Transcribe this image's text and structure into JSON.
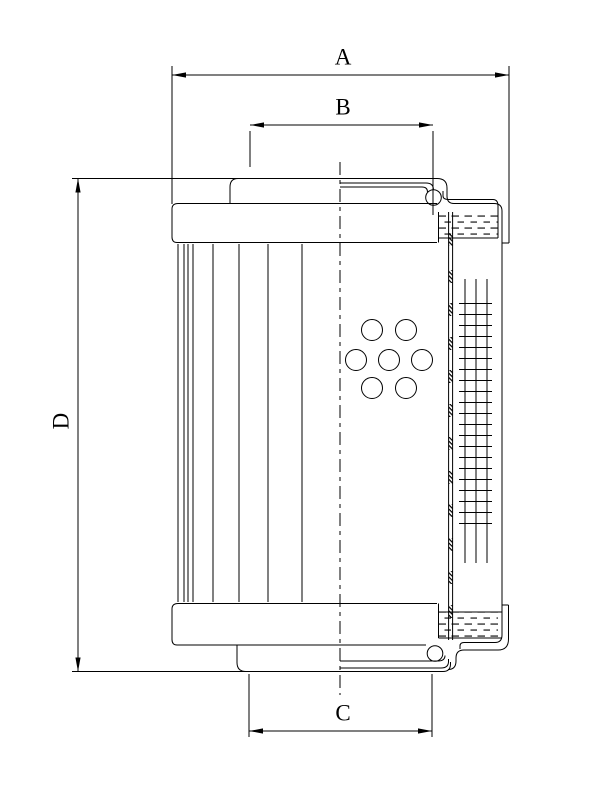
{
  "page": {
    "background_color": "#ffffff",
    "line_color": "#000000"
  },
  "drawing": {
    "type": "technical-drawing",
    "labels": {
      "a": "A",
      "b": "B",
      "c": "C",
      "d": "D"
    }
  }
}
